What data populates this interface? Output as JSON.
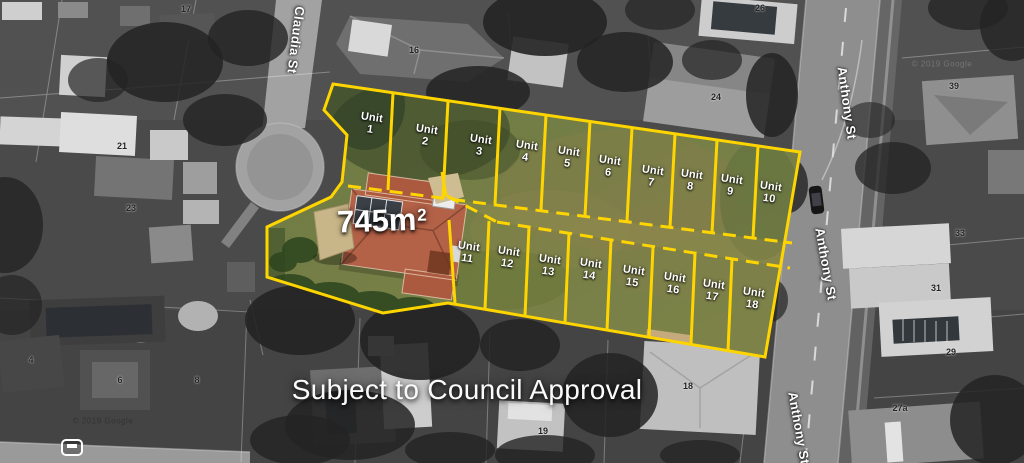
{
  "map": {
    "streets": [
      {
        "name": "Claudia St",
        "x": 296,
        "y": 40,
        "rot": 97
      },
      {
        "name": "Anthony St",
        "x": 847,
        "y": 103,
        "rot": 82
      },
      {
        "name": "Anthony St",
        "x": 826,
        "y": 264,
        "rot": 80
      },
      {
        "name": "Anthony St",
        "x": 799,
        "y": 428,
        "rot": 80
      }
    ],
    "house_numbers": [
      {
        "label": "17",
        "x": 186,
        "y": 9
      },
      {
        "label": "16",
        "x": 414,
        "y": 50
      },
      {
        "label": "26",
        "x": 760,
        "y": 8
      },
      {
        "label": "24",
        "x": 716,
        "y": 97
      },
      {
        "label": "39",
        "x": 954,
        "y": 86
      },
      {
        "label": "21",
        "x": 122,
        "y": 146
      },
      {
        "label": "23",
        "x": 131,
        "y": 208
      },
      {
        "label": "4",
        "x": 31,
        "y": 360
      },
      {
        "label": "6",
        "x": 120,
        "y": 380
      },
      {
        "label": "8",
        "x": 197,
        "y": 380
      },
      {
        "label": "18",
        "x": 688,
        "y": 386
      },
      {
        "label": "19",
        "x": 543,
        "y": 431
      },
      {
        "label": "33",
        "x": 960,
        "y": 233
      },
      {
        "label": "31",
        "x": 936,
        "y": 288
      },
      {
        "label": "29",
        "x": 951,
        "y": 352
      },
      {
        "label": "27a",
        "x": 900,
        "y": 408
      }
    ],
    "watermarks": [
      {
        "text": "© 2019 Google",
        "x": 942,
        "y": 64,
        "theme": "light"
      },
      {
        "text": "© 2019 Google",
        "x": 103,
        "y": 421,
        "theme": "dark"
      }
    ]
  },
  "plan": {
    "area_label": {
      "value": "745m",
      "sup": "2"
    },
    "note": {
      "text": "Subject to Council Approval"
    },
    "units": [
      {
        "word": "Unit",
        "number": "1",
        "x": 371,
        "y": 124,
        "rot": 8
      },
      {
        "word": "Unit",
        "number": "2",
        "x": 426,
        "y": 136,
        "rot": 8
      },
      {
        "word": "Unit",
        "number": "3",
        "x": 480,
        "y": 146,
        "rot": 8
      },
      {
        "word": "Unit",
        "number": "4",
        "x": 526,
        "y": 152,
        "rot": 8
      },
      {
        "word": "Unit",
        "number": "5",
        "x": 568,
        "y": 158,
        "rot": 8
      },
      {
        "word": "Unit",
        "number": "6",
        "x": 609,
        "y": 167,
        "rot": 8
      },
      {
        "word": "Unit",
        "number": "7",
        "x": 652,
        "y": 177,
        "rot": 8
      },
      {
        "word": "Unit",
        "number": "8",
        "x": 691,
        "y": 181,
        "rot": 8
      },
      {
        "word": "Unit",
        "number": "9",
        "x": 731,
        "y": 186,
        "rot": 8
      },
      {
        "word": "Unit",
        "number": "10",
        "x": 770,
        "y": 193,
        "rot": 8
      },
      {
        "word": "Unit",
        "number": "11",
        "x": 468,
        "y": 253,
        "rot": 8
      },
      {
        "word": "Unit",
        "number": "12",
        "x": 508,
        "y": 258,
        "rot": 8
      },
      {
        "word": "Unit",
        "number": "13",
        "x": 549,
        "y": 266,
        "rot": 8
      },
      {
        "word": "Unit",
        "number": "14",
        "x": 590,
        "y": 270,
        "rot": 8
      },
      {
        "word": "Unit",
        "number": "15",
        "x": 633,
        "y": 277,
        "rot": 8
      },
      {
        "word": "Unit",
        "number": "16",
        "x": 674,
        "y": 284,
        "rot": 8
      },
      {
        "word": "Unit",
        "number": "17",
        "x": 713,
        "y": 291,
        "rot": 8
      },
      {
        "word": "Unit",
        "number": "18",
        "x": 753,
        "y": 299,
        "rot": 8
      }
    ]
  },
  "colors": {
    "boundary_yellow": "#FFD500",
    "site_green": "#76814B",
    "highlight_roof": "#B36147"
  }
}
